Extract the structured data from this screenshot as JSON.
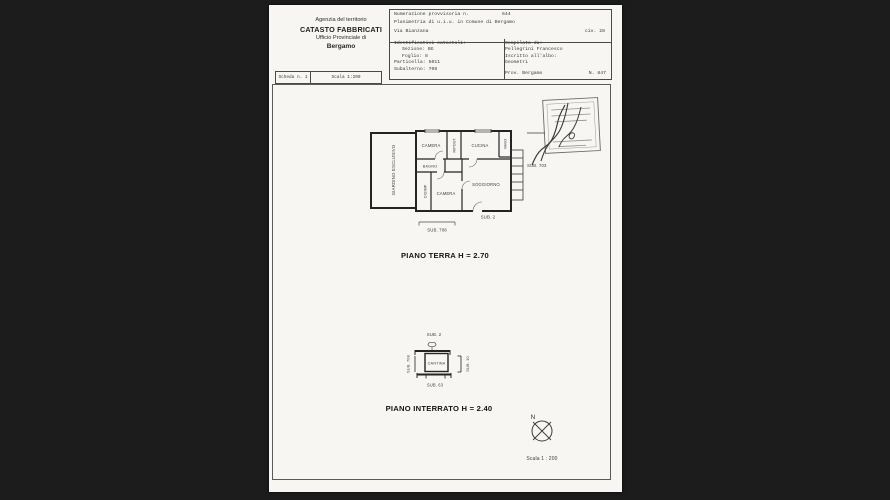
{
  "colors": {
    "background": "#1b1c1b",
    "paper": "#f7f6f2",
    "ink": "#242424"
  },
  "header": {
    "agency": {
      "line1": "Agenzia del territorio",
      "line2": "CATASTO FABBRICATI",
      "line3": "Ufficio Provinciale di",
      "line4": "Bergamo"
    },
    "registration": {
      "row1_label": "Numerazione provvisoria n.",
      "row1_value": "644",
      "row2": "Planimetria di u.i.u. in Comune di Bergamo",
      "row3_street": "Via Bianzana",
      "row3_civ": "civ. 28"
    },
    "catasto": {
      "title": "Identificativi catastali:",
      "fields": [
        {
          "label": "Sezione:",
          "value": "BG"
        },
        {
          "label": "Foglio:",
          "value": "8"
        },
        {
          "label": "Particella:",
          "value": "5011"
        },
        {
          "label": "Subalterno:",
          "value": "708"
        }
      ]
    },
    "compiler": {
      "title": "Compilata da:",
      "name": "Pellegrini Francesco",
      "albo_label": "Iscritto all'albo:",
      "albo_value": "Geometri",
      "prov": "Prov. Bergamo",
      "number": "N.  847"
    },
    "scheda": {
      "label": "Scheda n. 1",
      "scala": "Scala 1:200"
    }
  },
  "plans": {
    "terra": {
      "rooms": {
        "giardino": "GIARDINO ESCLUSIVO",
        "camera1": "CAMERA",
        "ripost": "RIPOST.",
        "cucina": "CUCINA",
        "vano": "VANO",
        "bagno": "BAGNO",
        "disimp": "DISIMP.",
        "camera2": "CAMERA",
        "soggiorno": "SOGGIORNO"
      },
      "sub_right": "SUB. 703",
      "sub_inner": "SUB. 2",
      "sub_dim": "SUB. 708",
      "title": "PIANO TERRA H = 2.70"
    },
    "interrato": {
      "sub_top": "SUB. 2",
      "room": "CANTINA",
      "sub_left": "SUB. 708",
      "sub_right": "SUB. 10",
      "sub_bottom": "SUB. 63",
      "title": "PIANO INTERRATO H = 2.40"
    }
  },
  "footer": {
    "north": "N",
    "scale": "Scala 1 : 200"
  }
}
